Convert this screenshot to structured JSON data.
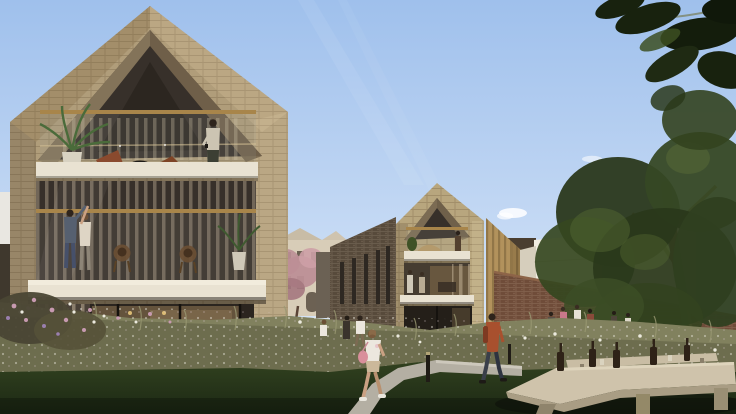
{
  "scene": {
    "type": "architectural-rendering",
    "subject": "modern gabled brick apartment houses with balconies, residents, wildflower meadow, lawn, brick garden wall, trees and picnic table"
  },
  "palette": {
    "sky_top": "#9fc0ec",
    "sky_mid": "#c9dcf5",
    "sky_low": "#e6edf8",
    "cloud": "#ffffff",
    "brick_light": "#b09d7a",
    "brick_gable": "#b8a67e",
    "brick_shadow": "#8d7b5e",
    "slab": "#e9e2d2",
    "rail_gold": "#a8854a",
    "interior_dark": "#37302a",
    "interior_warm": "#6e5c42",
    "curtain": "#b7a88e",
    "rowhouse_dark": "#574a3b",
    "gold_slat": "#b2925c",
    "cream_building": "#d8cdb8",
    "white_building_light": "#f1ede1",
    "white_building_shade": "#ddd5c4",
    "wall_brick": "#6f4c39",
    "tree_dark": "#2a381b",
    "tree_mid": "#35461f",
    "tree_light": "#526631",
    "leaf_overhang": "#18220e",
    "trunk": "#8a6d49",
    "meadow_base": "#6d6d4e",
    "meadow_light": "#9a9973",
    "lawn_top": "#31411f",
    "lawn_bottom": "#1c2814",
    "path": "#b4afa3",
    "table_wood": "#cfc3ab",
    "table_edge": "#a99d84",
    "bottle": "#2e2217",
    "bench_white": "#e7e2d4",
    "skin": "#caa183",
    "hair_dark": "#2e241c",
    "shirt_white": "#ece7de",
    "bag_pink": "#d98f9b",
    "shorts_tan": "#cbb89a",
    "jacket_red": "#a8502e",
    "pants_dark": "#3a3f4a",
    "denim": "#566070",
    "blossom": "#bd8f96",
    "flower_white": "#eceade",
    "flower_pink": "#c79ab0",
    "bollard": "#201c16"
  },
  "objects": [
    "sky",
    "sun-rays",
    "cloud",
    "left-gable-house",
    "top-balcony",
    "middle-balcony",
    "ground-floor-interior",
    "potted-palm",
    "wicker-chair",
    "resident-on-balcony",
    "dancing-couple",
    "child-indoors",
    "middle-gable-house",
    "rowhouse-wing",
    "gold-slat-building",
    "cream-heritage-building",
    "flowering-tree",
    "white-buildings",
    "garden-brick-wall",
    "large-tree",
    "overhanging-leaves",
    "wildflower-meadow",
    "flower-clusters",
    "lawn",
    "footpath",
    "light-bollard",
    "walking-woman",
    "walking-man",
    "meadow-child",
    "meadow-person",
    "group-at-benches",
    "planter-bench",
    "picnic-table",
    "far-bench",
    "wine-bottles"
  ]
}
